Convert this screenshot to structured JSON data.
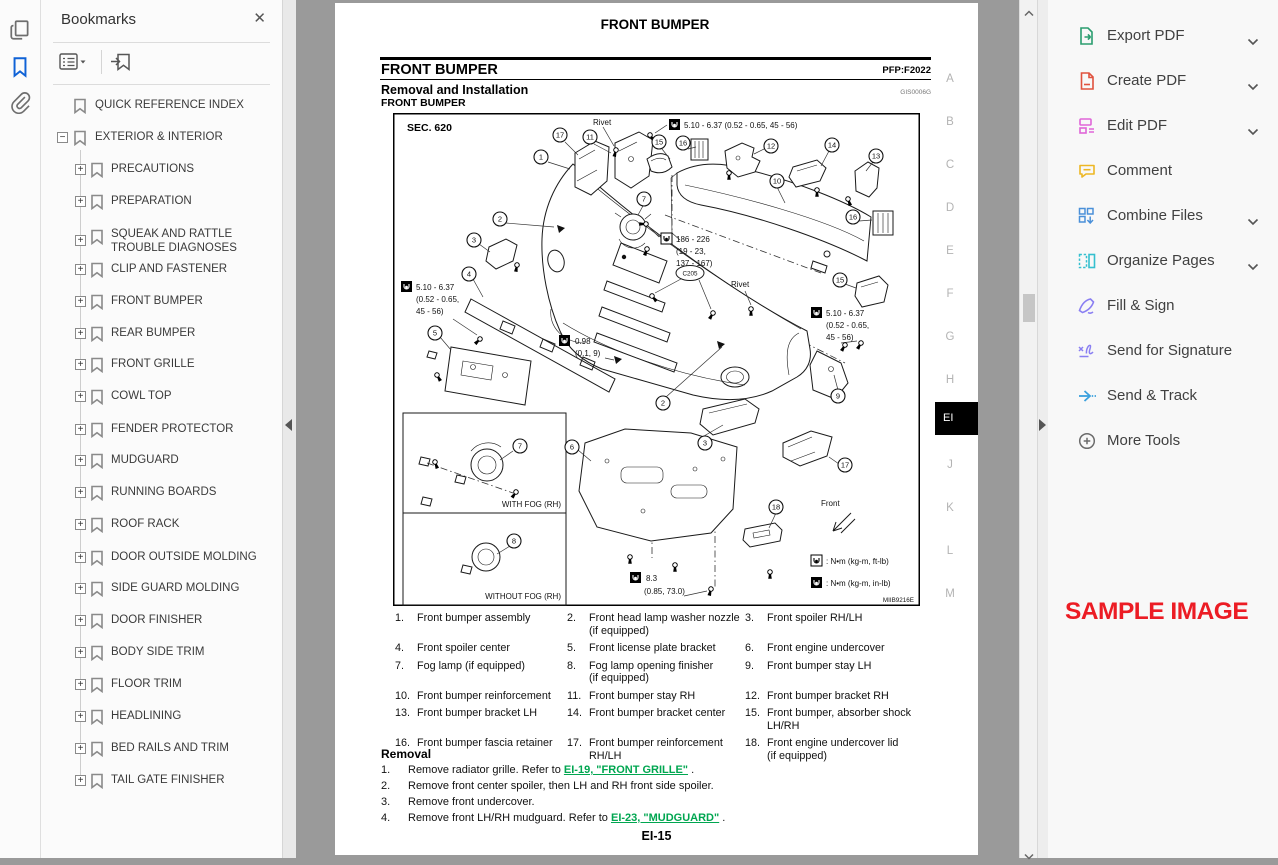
{
  "left_rail": {
    "icons": [
      "page-thumbnails-icon",
      "bookmarks-icon",
      "attachments-icon"
    ]
  },
  "bookmarks_panel": {
    "title": "Bookmarks",
    "close_label": "✕",
    "items": [
      {
        "label": "QUICK REFERENCE INDEX",
        "level": 0,
        "expander": null,
        "y": 106
      },
      {
        "label": "EXTERIOR & INTERIOR",
        "level": 0,
        "expander": "minus",
        "y": 138
      },
      {
        "label": "PRECAUTIONS",
        "level": 1,
        "expander": "plus",
        "y": 170
      },
      {
        "label": "PREPARATION",
        "level": 1,
        "expander": "plus",
        "y": 202
      },
      {
        "label": "SQUEAK AND RATTLE\nTROUBLE DIAGNOSES",
        "level": 1,
        "expander": "plus",
        "y": 241
      },
      {
        "label": "CLIP AND FASTENER",
        "level": 1,
        "expander": "plus",
        "y": 270
      },
      {
        "label": "FRONT BUMPER",
        "level": 1,
        "expander": "plus",
        "y": 302
      },
      {
        "label": "REAR BUMPER",
        "level": 1,
        "expander": "plus",
        "y": 334
      },
      {
        "label": "FRONT GRILLE",
        "level": 1,
        "expander": "plus",
        "y": 365
      },
      {
        "label": "COWL TOP",
        "level": 1,
        "expander": "plus",
        "y": 397
      },
      {
        "label": "FENDER PROTECTOR",
        "level": 1,
        "expander": "plus",
        "y": 430
      },
      {
        "label": "MUDGUARD",
        "level": 1,
        "expander": "plus",
        "y": 461
      },
      {
        "label": "RUNNING BOARDS",
        "level": 1,
        "expander": "plus",
        "y": 493
      },
      {
        "label": "ROOF RACK",
        "level": 1,
        "expander": "plus",
        "y": 525
      },
      {
        "label": "DOOR OUTSIDE MOLDING",
        "level": 1,
        "expander": "plus",
        "y": 558
      },
      {
        "label": "SIDE GUARD MOLDING",
        "level": 1,
        "expander": "plus",
        "y": 589
      },
      {
        "label": "DOOR FINISHER",
        "level": 1,
        "expander": "plus",
        "y": 621
      },
      {
        "label": "BODY SIDE TRIM",
        "level": 1,
        "expander": "plus",
        "y": 653
      },
      {
        "label": "FLOOR TRIM",
        "level": 1,
        "expander": "plus",
        "y": 685
      },
      {
        "label": "HEADLINING",
        "level": 1,
        "expander": "plus",
        "y": 717
      },
      {
        "label": "BED RAILS AND TRIM",
        "level": 1,
        "expander": "plus",
        "y": 749
      },
      {
        "label": "TAIL GATE FINISHER",
        "level": 1,
        "expander": "plus",
        "y": 781
      }
    ]
  },
  "pdf": {
    "running_header": "FRONT BUMPER",
    "section_title": "FRONT BUMPER",
    "pfp_code": "PFP:F2022",
    "subsection_title": "Removal and Installation",
    "doc_code": "GIS0006G",
    "sub_label": "FRONT BUMPER",
    "diagram": {
      "sec": "SEC. 620",
      "rivet": "Rivet",
      "t1": "5.10 - 6.37 (0.52 - 0.65, 45 - 56)",
      "t2": [
        "186 - 226",
        "(19 - 23,",
        "137 - 167)"
      ],
      "t34": [
        "5.10 - 6.37",
        "(0.52 - 0.65,",
        "45 - 56)"
      ],
      "t5": [
        "0.98",
        "(0.1, 9)"
      ],
      "t6": [
        "8.3",
        "(0.85, 73.0)"
      ],
      "with_fog": "WITH FOG (RH)",
      "without_fog": "WITHOUT FOG (RH)",
      "front": "Front",
      "legend_ft": ": N•m (kg-m, ft-lb)",
      "legend_in": ": N•m (kg-m, in-lb)",
      "connector": "C205",
      "code": "MIIB9216E",
      "callouts": [
        [
          1,
          148,
          44
        ],
        [
          17,
          167,
          22
        ],
        [
          11,
          197,
          24
        ],
        [
          15,
          266,
          29
        ],
        [
          16,
          290,
          30
        ],
        [
          12,
          378,
          33
        ],
        [
          14,
          439,
          32
        ],
        [
          13,
          483,
          43
        ],
        [
          10,
          384,
          68
        ],
        [
          16,
          460,
          104
        ],
        [
          7,
          251,
          86
        ],
        [
          2,
          107,
          106
        ],
        [
          3,
          81,
          127
        ],
        [
          4,
          76,
          161
        ],
        [
          5,
          42,
          220
        ],
        [
          15,
          447,
          167
        ],
        [
          9,
          445,
          283
        ],
        [
          2,
          270,
          290
        ],
        [
          3,
          312,
          330
        ],
        [
          6,
          179,
          334
        ],
        [
          17,
          452,
          352
        ],
        [
          18,
          383,
          394
        ],
        [
          7,
          127,
          333
        ],
        [
          8,
          121,
          428
        ]
      ]
    },
    "parts": [
      [
        "1.",
        "Front bumper assembly"
      ],
      [
        "2.",
        "Front head lamp washer nozzle\n(if equipped)"
      ],
      [
        "3.",
        "Front spoiler RH/LH"
      ],
      [
        "4.",
        "Front spoiler center"
      ],
      [
        "5.",
        "Front license plate bracket"
      ],
      [
        "6.",
        "Front engine undercover"
      ],
      [
        "7.",
        "Fog lamp (if equipped)"
      ],
      [
        "8.",
        "Fog lamp opening finisher\n(if equipped)"
      ],
      [
        "9.",
        "Front bumper stay LH"
      ],
      [
        "10.",
        "Front bumper reinforcement"
      ],
      [
        "11.",
        "Front bumper stay RH"
      ],
      [
        "12.",
        "Front bumper bracket RH"
      ],
      [
        "13.",
        "Front bumper bracket LH"
      ],
      [
        "14.",
        "Front bumper bracket center"
      ],
      [
        "15.",
        "Front bumper, absorber shock\nLH/RH"
      ],
      [
        "16.",
        "Front bumper fascia retainer"
      ],
      [
        "17.",
        "Front bumper reinforcement RH/LH"
      ],
      [
        "18.",
        "Front engine undercover lid\n(if equipped)"
      ]
    ],
    "removal": {
      "heading": "Removal",
      "steps": [
        {
          "num": "1.",
          "text": "Remove radiator grille. Refer to ",
          "link": "EI-19, \"FRONT GRILLE\"",
          "after": " ."
        },
        {
          "num": "2.",
          "text": "Remove front center spoiler, then LH and RH front side spoiler.",
          "link": null,
          "after": ""
        },
        {
          "num": "3.",
          "text": "Remove front undercover.",
          "link": null,
          "after": ""
        },
        {
          "num": "4.",
          "text": "Remove front LH/RH mudguard. Refer to ",
          "link": "EI-23, \"MUDGUARD\"",
          "after": " ."
        }
      ]
    },
    "page_number": "EI-15",
    "side_tabs": [
      "A",
      "B",
      "C",
      "D",
      "E",
      "F",
      "G",
      "H",
      "EI",
      "J",
      "K",
      "L",
      "M"
    ],
    "active_tab": "EI"
  },
  "tools_panel": {
    "items": [
      {
        "label": "Export PDF",
        "icon": "export-pdf-icon",
        "chevron": true
      },
      {
        "label": "Create PDF",
        "icon": "create-pdf-icon",
        "chevron": true
      },
      {
        "label": "Edit PDF",
        "icon": "edit-pdf-icon",
        "chevron": true
      },
      {
        "label": "Comment",
        "icon": "comment-icon",
        "chevron": false
      },
      {
        "label": "Combine Files",
        "icon": "combine-files-icon",
        "chevron": true
      },
      {
        "label": "Organize Pages",
        "icon": "organize-pages-icon",
        "chevron": true
      },
      {
        "label": "Fill & Sign",
        "icon": "fill-sign-icon",
        "chevron": false
      },
      {
        "label": "Send for Signature",
        "icon": "send-signature-icon",
        "chevron": false
      },
      {
        "label": "Send & Track",
        "icon": "send-track-icon",
        "chevron": false
      },
      {
        "label": "More Tools",
        "icon": "more-tools-icon",
        "chevron": false
      }
    ],
    "sample_text": "SAMPLE IMAGE",
    "sample_color": "#ec1c24"
  }
}
